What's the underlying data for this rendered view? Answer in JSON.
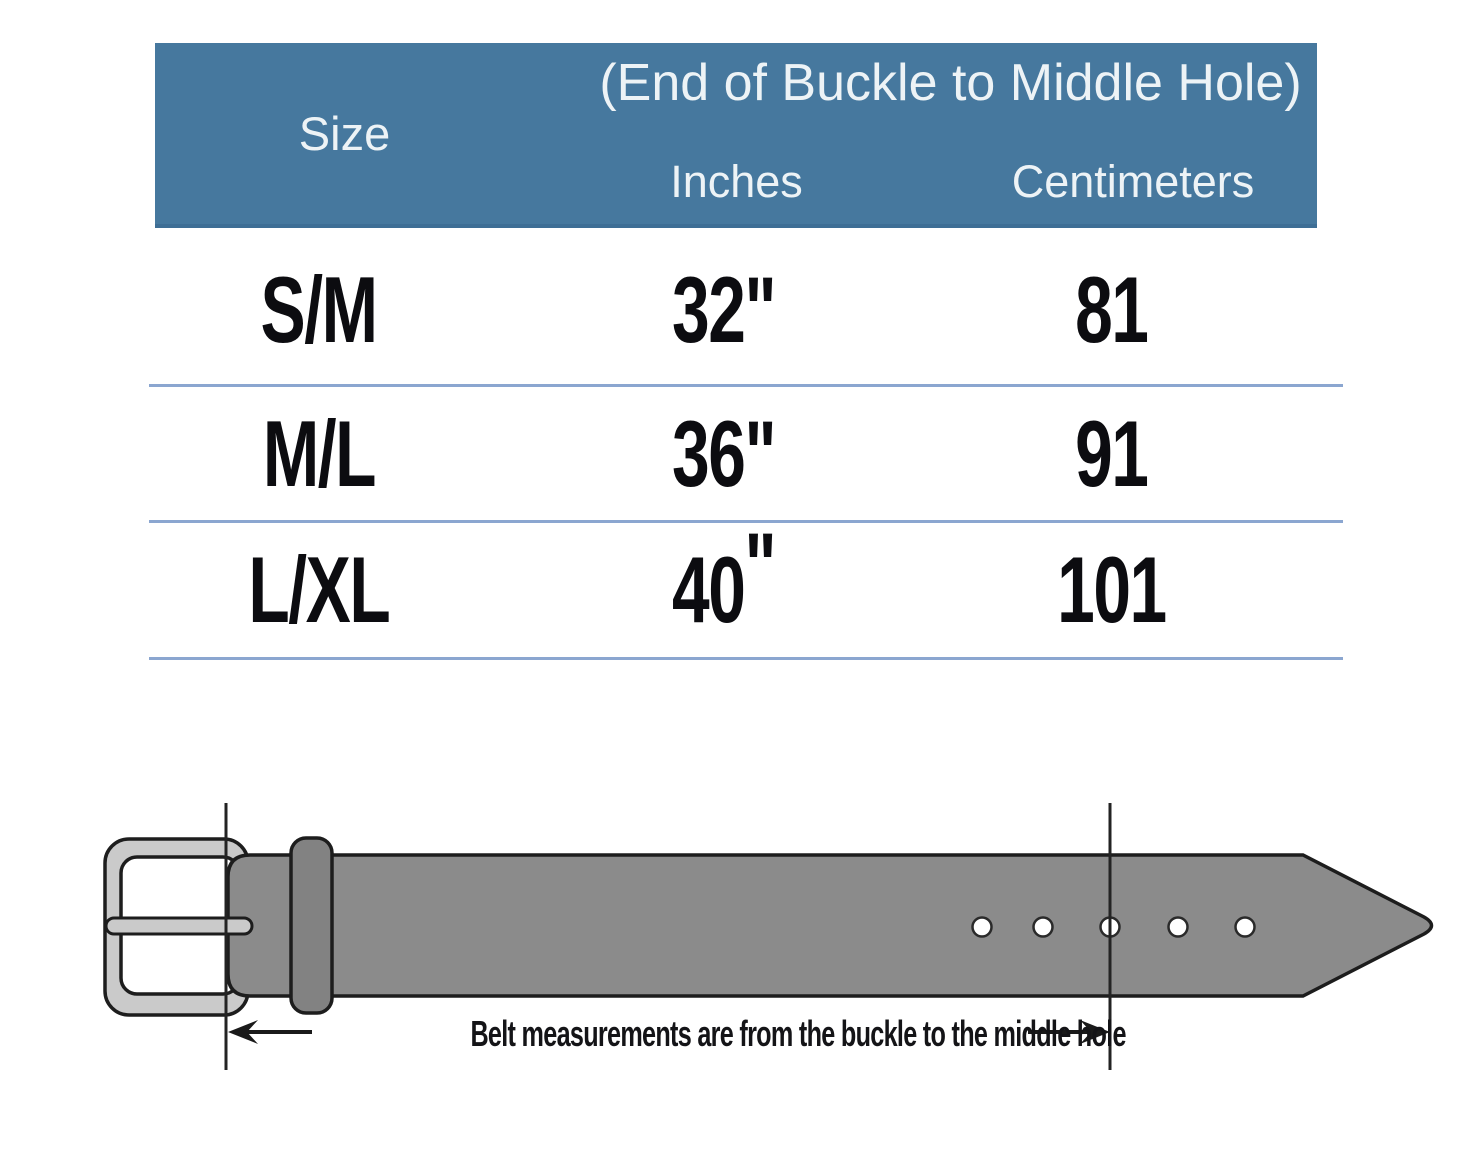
{
  "table": {
    "header": {
      "size_label": "Size",
      "group_label": "(End of Buckle to Middle Hole)",
      "inches_label": "Inches",
      "centimeters_label": "Centimeters"
    },
    "rows": [
      {
        "size": "S/M",
        "inches_num": "32",
        "inches_mark": "\"",
        "cm": "81"
      },
      {
        "size": "M/L",
        "inches_num": "36",
        "inches_mark": "\"",
        "cm": "91"
      },
      {
        "size": "L/XL",
        "inches_num": "40",
        "inches_mark": "\"",
        "cm": "101"
      }
    ]
  },
  "diagram": {
    "caption": "Belt measurements are from the buckle to the middle hole",
    "hole_count": 5
  },
  "colors": {
    "header_bg": "#46789e",
    "header_text": "#edf3f6",
    "divider": "#8ba6d0",
    "row_text": "#0c0c10",
    "belt_fill": "#8b8b8b",
    "keeper_fill": "#828282",
    "buckle_fill": "#cacaca",
    "outline": "#1d1d1d"
  }
}
